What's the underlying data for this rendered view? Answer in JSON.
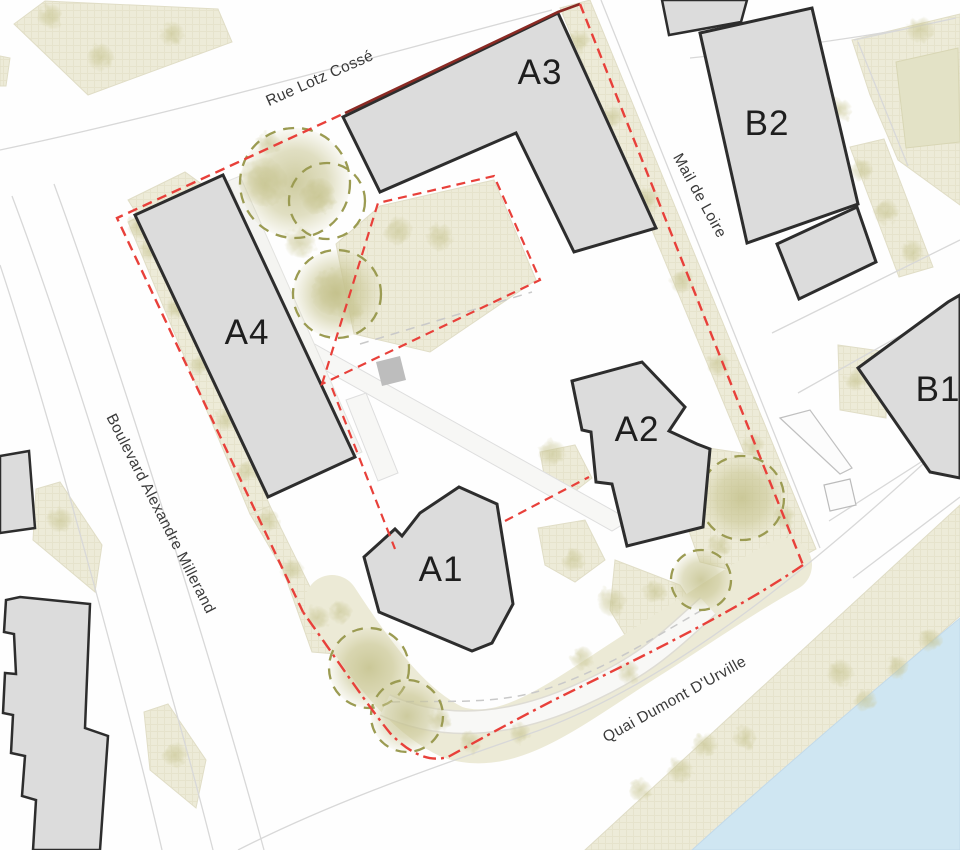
{
  "map": {
    "kind": "architectural site plan",
    "buildings": {
      "a1": "A1",
      "a2": "A2",
      "a3": "A3",
      "a4": "A4",
      "b1": "B1",
      "b2": "B2"
    },
    "streets": {
      "north": "Rue Lotz Cossé",
      "east": "Mail de Loire",
      "west": "Boulevard Alexandre Millerand",
      "south": "Quai Dumont D'Urville"
    },
    "colors": {
      "building_fill": "#dcdcdc",
      "building_outline": "#2d2d2d",
      "site_boundary_red": "#e8403a",
      "site_boundary_dark_red": "#8b2a24",
      "tree_circle_olive": "#9b9b52",
      "greenspace_beige": "#edebd8",
      "water_blue": "#cfe6f2",
      "street_line_gray": "#d8d8d8",
      "label_color": "#1e1e1e",
      "street_label_color": "#3a3a3a"
    }
  }
}
